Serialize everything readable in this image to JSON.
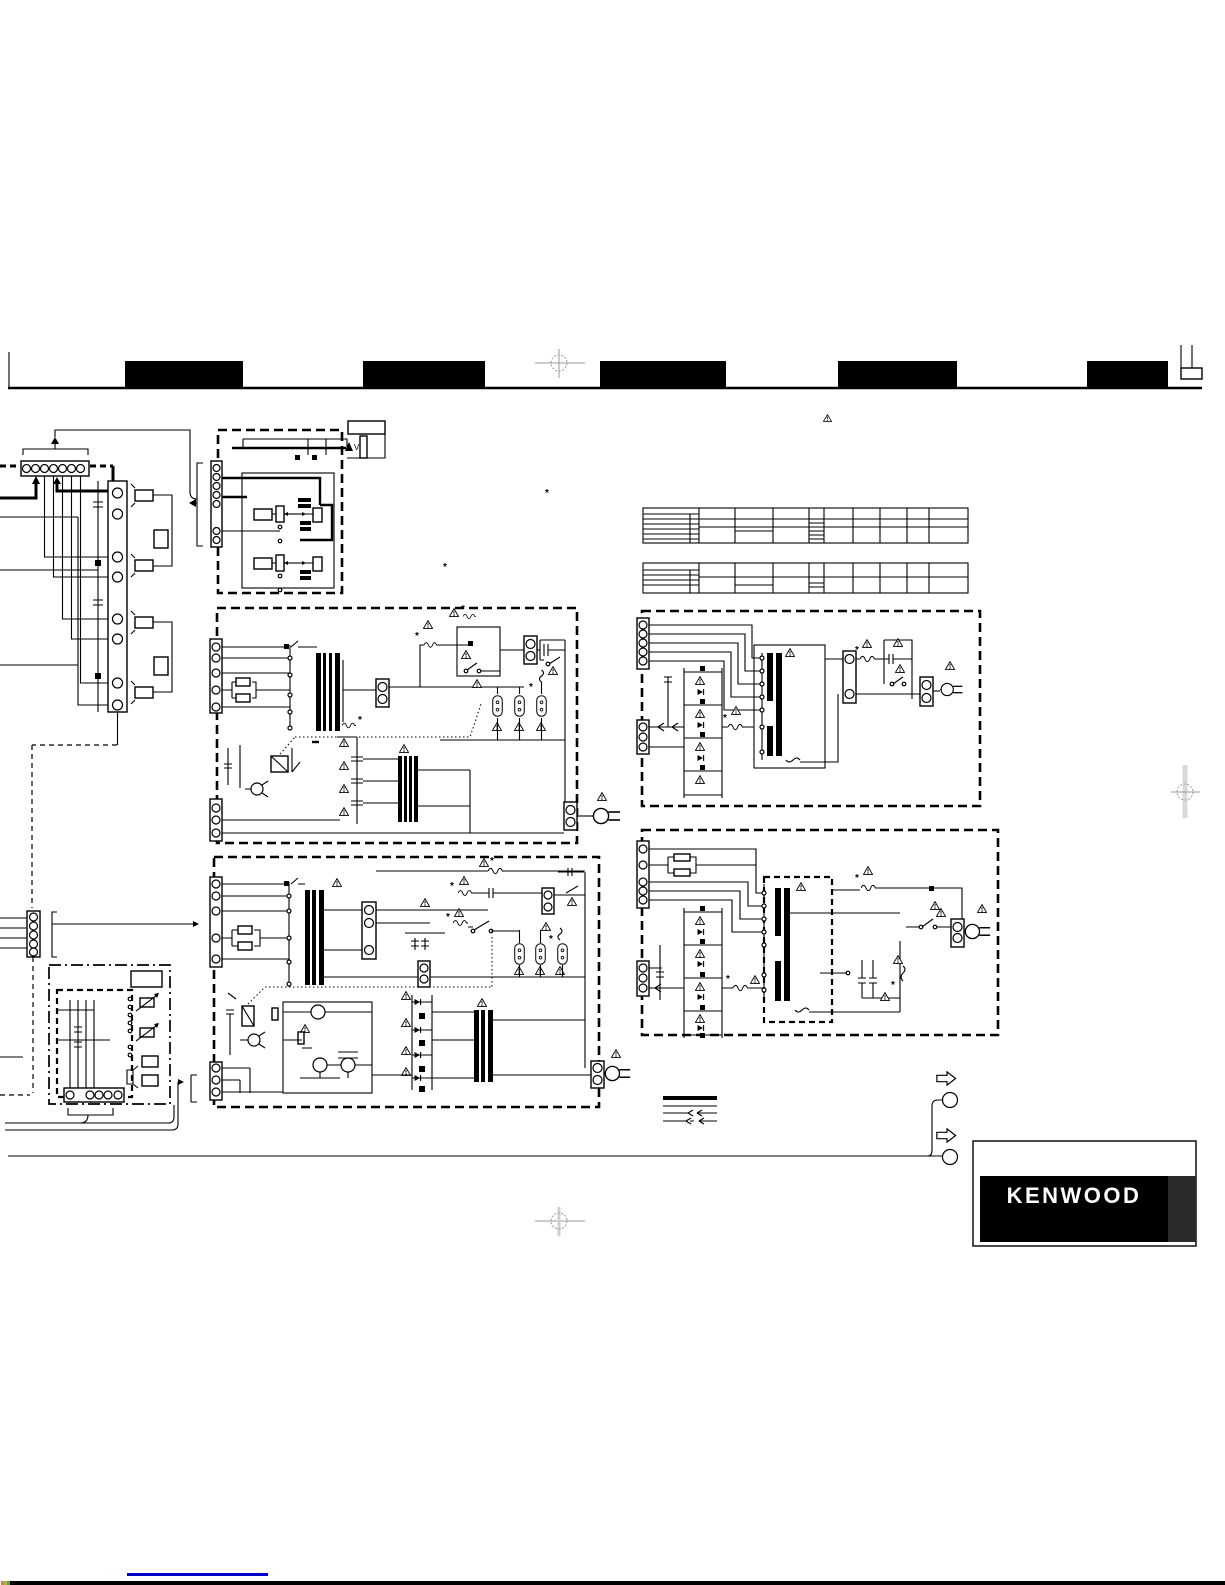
{
  "page": {
    "background": "#ffffff",
    "ink": "#000000"
  },
  "logo": {
    "text": "KENWOOD",
    "color": "#ffffff",
    "panel_bg": "#000000"
  },
  "symbols": {
    "asterisk": "*",
    "v_label": "V"
  }
}
